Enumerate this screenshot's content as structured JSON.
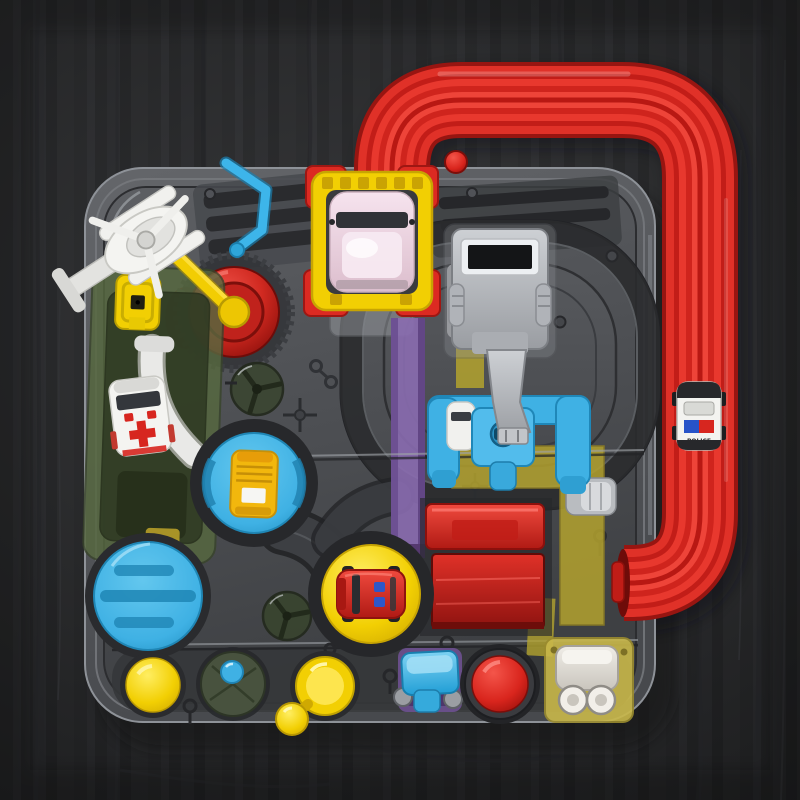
{
  "scene": {
    "type": "product-photo",
    "subject": "kids car adventure rescue track toy playset, top-down view",
    "background": "dark charcoal wood-grain surface",
    "components": [
      "transparent game board",
      "red elevated track loop",
      "police car on red track",
      "yellow gantry station with pink car",
      "gray excavator with arm",
      "blue crane lift with white car",
      "white seaplane launcher",
      "yellow launch rod",
      "red plunger button",
      "blue zigzag track",
      "green ramp housing with ambulance",
      "yellow latch button",
      "purple drop track",
      "oval race track",
      "blue turntable with yellow bus",
      "large blue turntable",
      "yellow turntable with red car",
      "red ramp panels",
      "olive track path",
      "yellow dome button",
      "green gear disc with blue knob",
      "green fan windows",
      "yellow lever with ball handle",
      "blue rocker switch",
      "red arcade button",
      "cream roller winch on yellow plate"
    ]
  },
  "police_car": {
    "label": "POLICE"
  },
  "palette": {
    "bg": "#2e2f31",
    "board_gray": "#54565a",
    "track_red": "#dc2a22",
    "accent_yellow": "#f2cf03",
    "accent_blue": "#3fb1e4",
    "button_red": "#e93a33",
    "ramp_green": "#4a5c3a",
    "strip_purple": "#8a6bb0",
    "path_olive": "#b3a22e",
    "car_pink": "#f0dbe7"
  }
}
